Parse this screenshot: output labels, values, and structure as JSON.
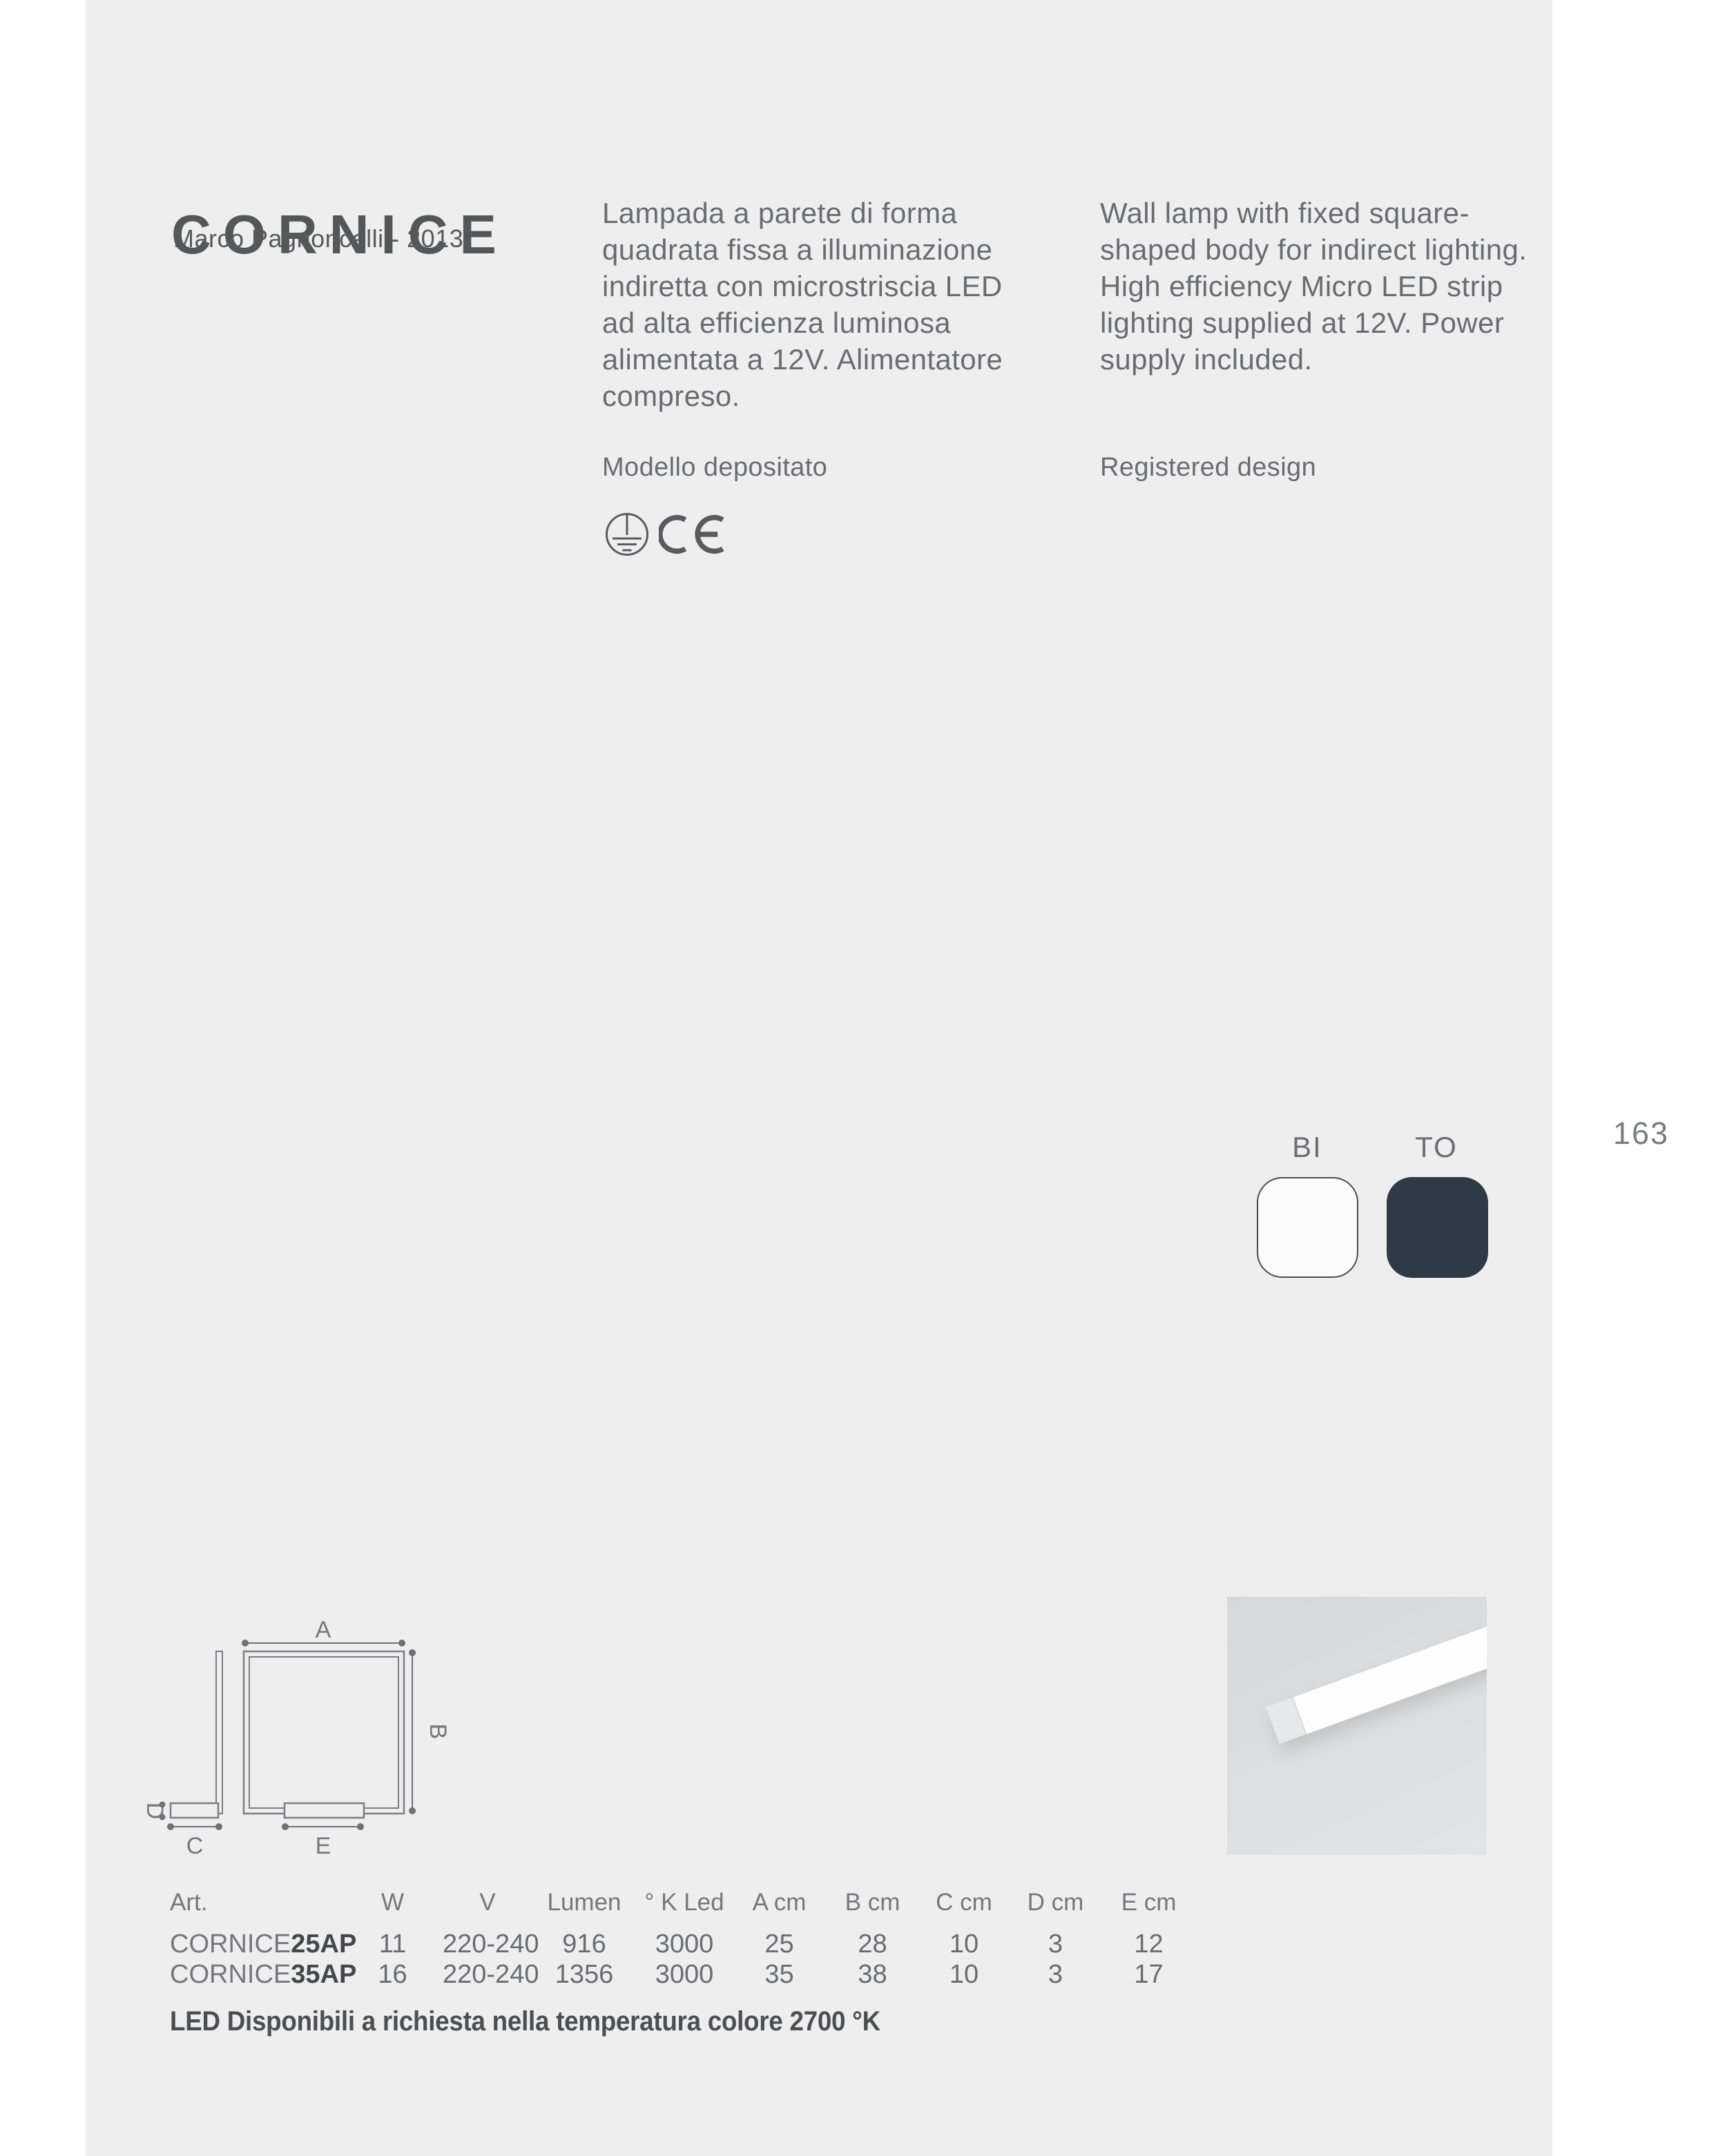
{
  "page": {
    "number": "163",
    "background": "#eeeeee",
    "margin_background": "#ffffff",
    "accent_text": "#55565a"
  },
  "header": {
    "title": "CORNICE",
    "designer": "Marco Pagnoncelli - 2013"
  },
  "description": {
    "italian": "Lampada a parete di forma\nquadrata fissa a illuminazione\nindiretta con microstriscia LED\nad alta efficienza luminosa\nalimentata a 12V. Alimentatore\ncompreso.",
    "english": "Wall lamp with fixed square-\nshaped body for indirect lighting.\nHigh efficiency Micro LED strip\nlighting supplied at 12V. Power\nsupply included.",
    "registered_it": "Modello depositato",
    "registered_en": "Registered design"
  },
  "certifications": {
    "icons": [
      "protective-earth-class-i",
      "ce-mark"
    ]
  },
  "finishes": [
    {
      "code": "BI",
      "color": "#fbfbfc"
    },
    {
      "code": "TO",
      "color": "#2e3a45"
    }
  ],
  "diagram": {
    "labels": [
      "A",
      "B",
      "C",
      "D",
      "E"
    ]
  },
  "table": {
    "headers": [
      "Art.",
      "W",
      "V",
      "Lumen",
      "° K Led",
      "A cm",
      "B cm",
      "C cm",
      "D cm",
      "E cm"
    ],
    "rows": [
      {
        "art": {
          "name": "CORNICE",
          "variant": "25AP"
        },
        "values": [
          "11",
          "220-240",
          "916",
          "3000",
          "25",
          "28",
          "10",
          "3",
          "12"
        ]
      },
      {
        "art": {
          "name": "CORNICE",
          "variant": "35AP"
        },
        "values": [
          "16",
          "220-240",
          "1356",
          "3000",
          "35",
          "38",
          "10",
          "3",
          "17"
        ]
      }
    ],
    "footnote": "LED Disponibili a richiesta nella temperatura colore 2700 °K"
  }
}
